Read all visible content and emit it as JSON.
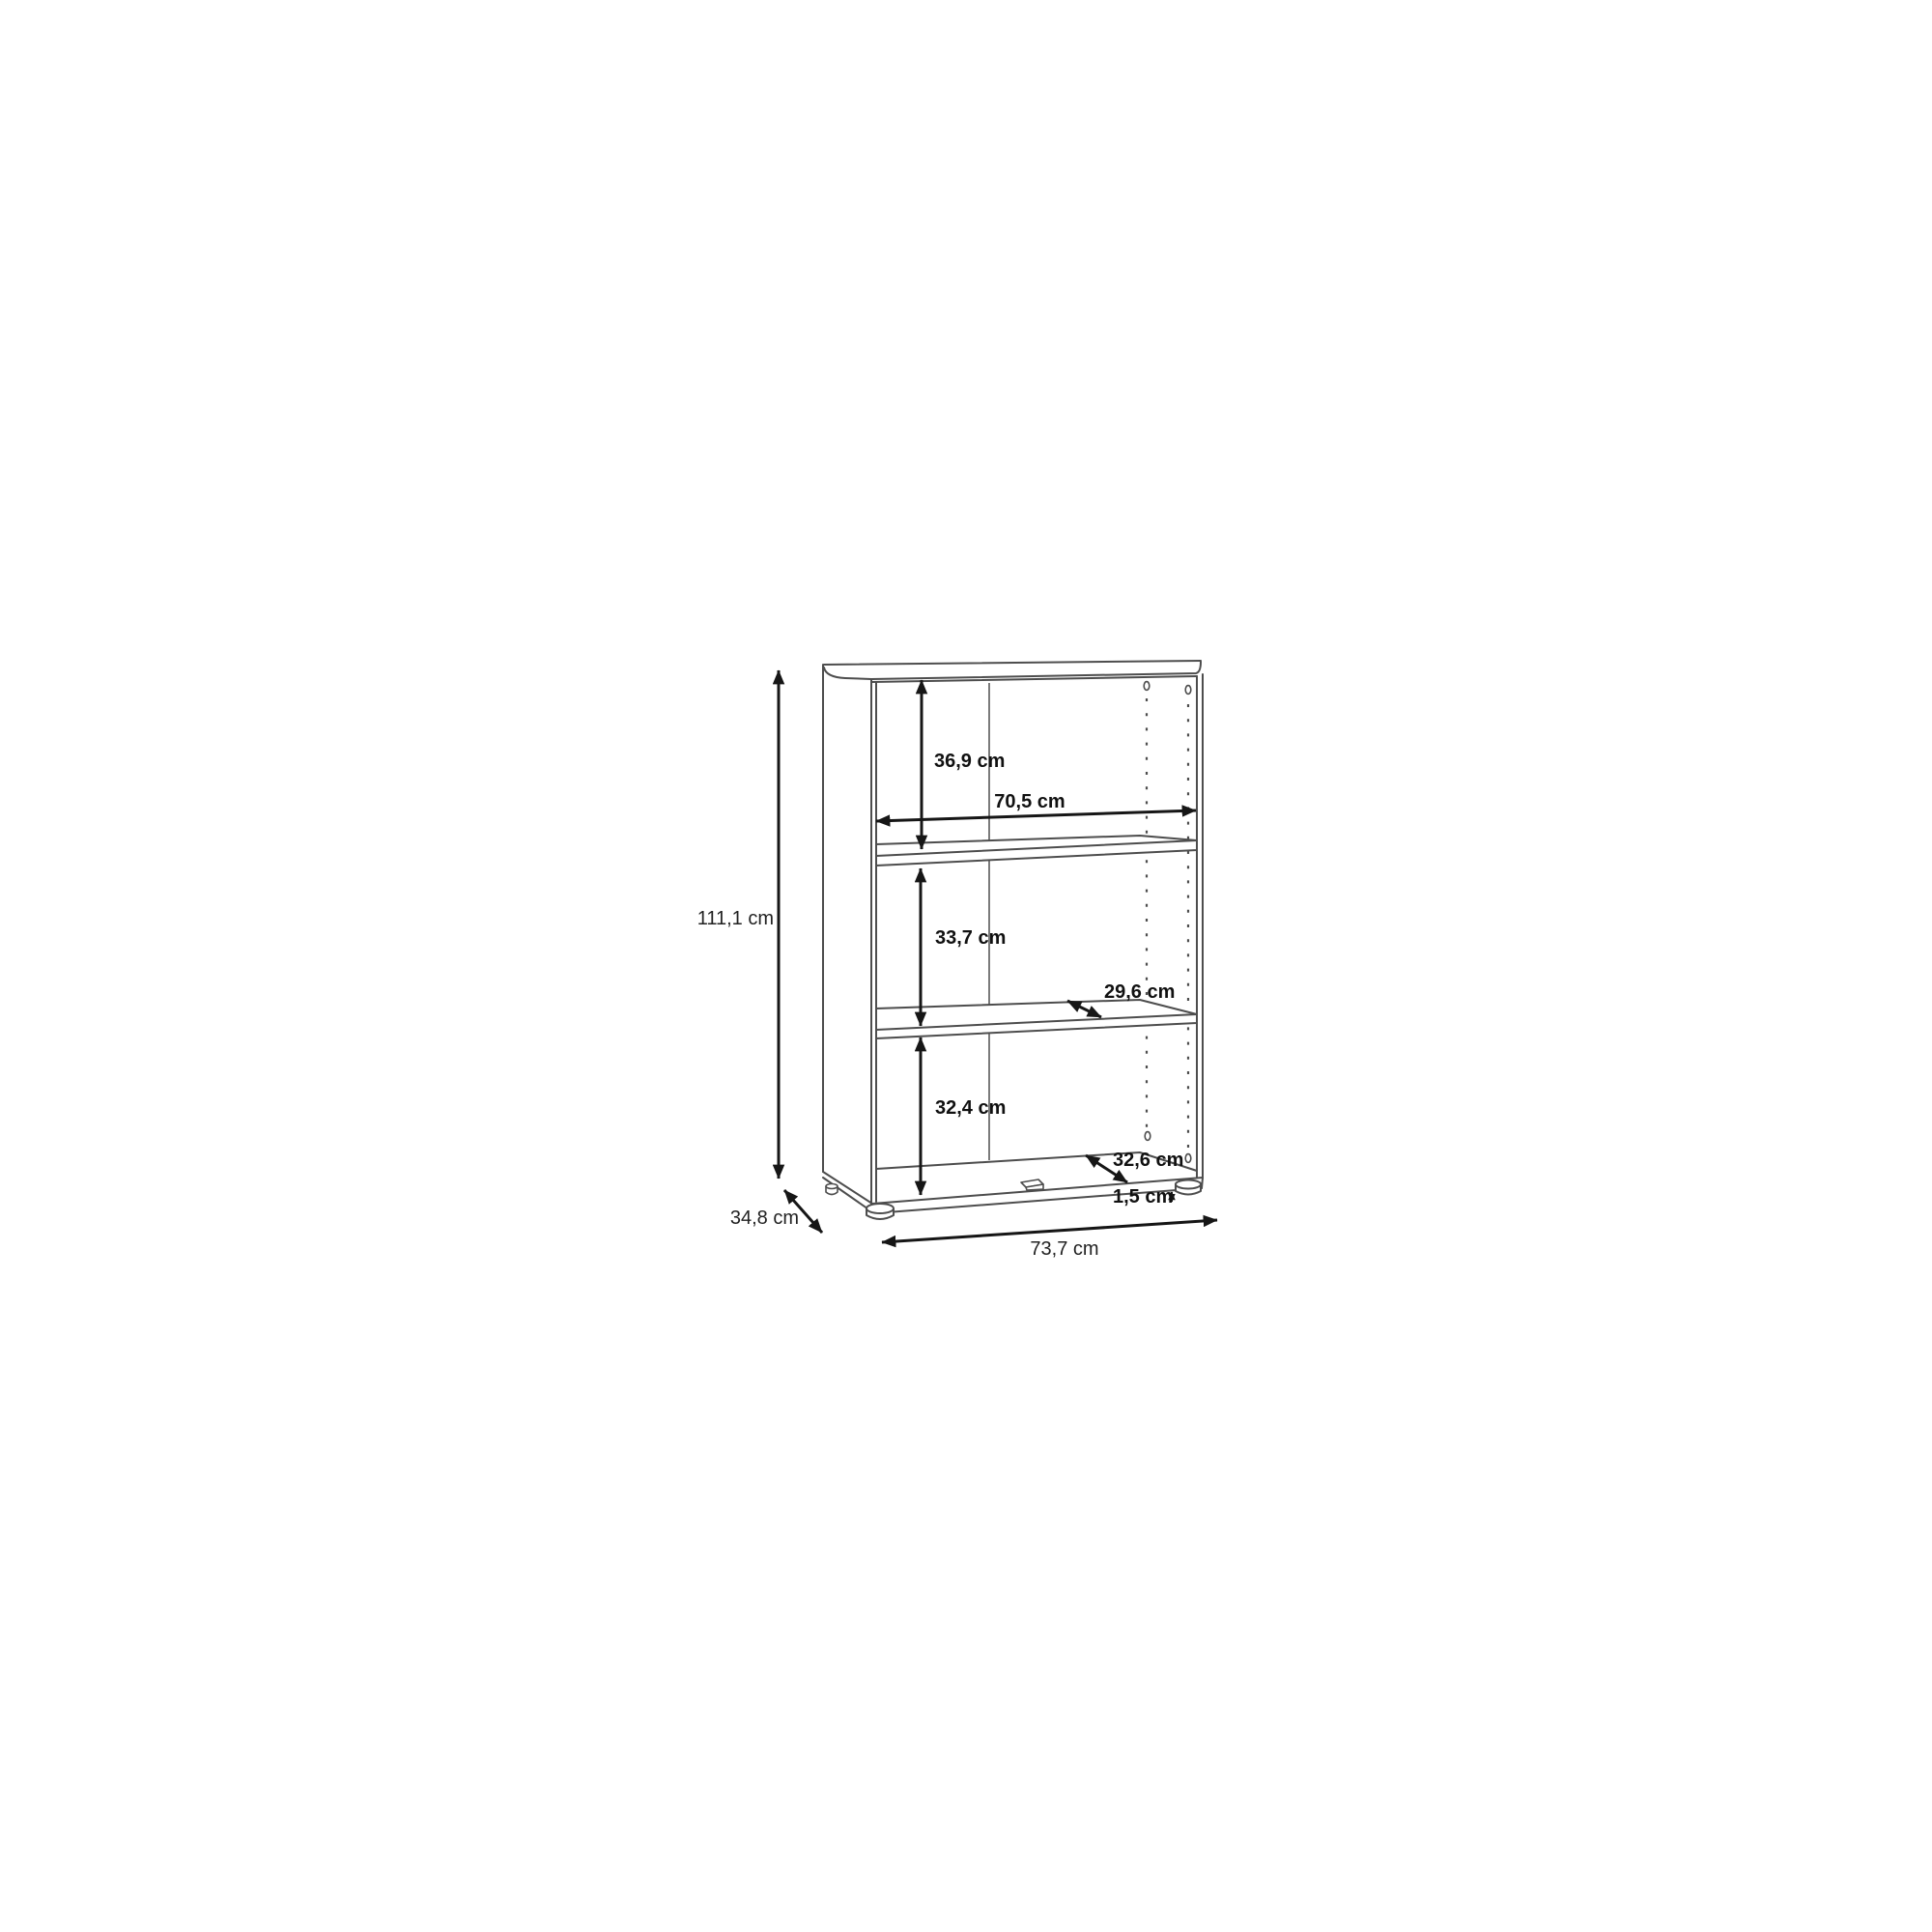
{
  "drawing": {
    "dims": {
      "overall_height": "111,1 cm",
      "overall_depth": "34,8 cm",
      "overall_width": "73,7 cm",
      "top_compartment": "36,9 cm",
      "internal_width": "70,5 cm",
      "middle_compartment": "33,7 cm",
      "shelf_depth": "29,6 cm",
      "bottom_compartment": "32,4 cm",
      "internal_depth": "32,6 cm",
      "foot_height": "1,5 cm"
    },
    "colors": {
      "background": "#ffffff",
      "cabinet_line": "#4d4d4d",
      "dimension_line": "#161616",
      "label_text": "#111111"
    }
  }
}
